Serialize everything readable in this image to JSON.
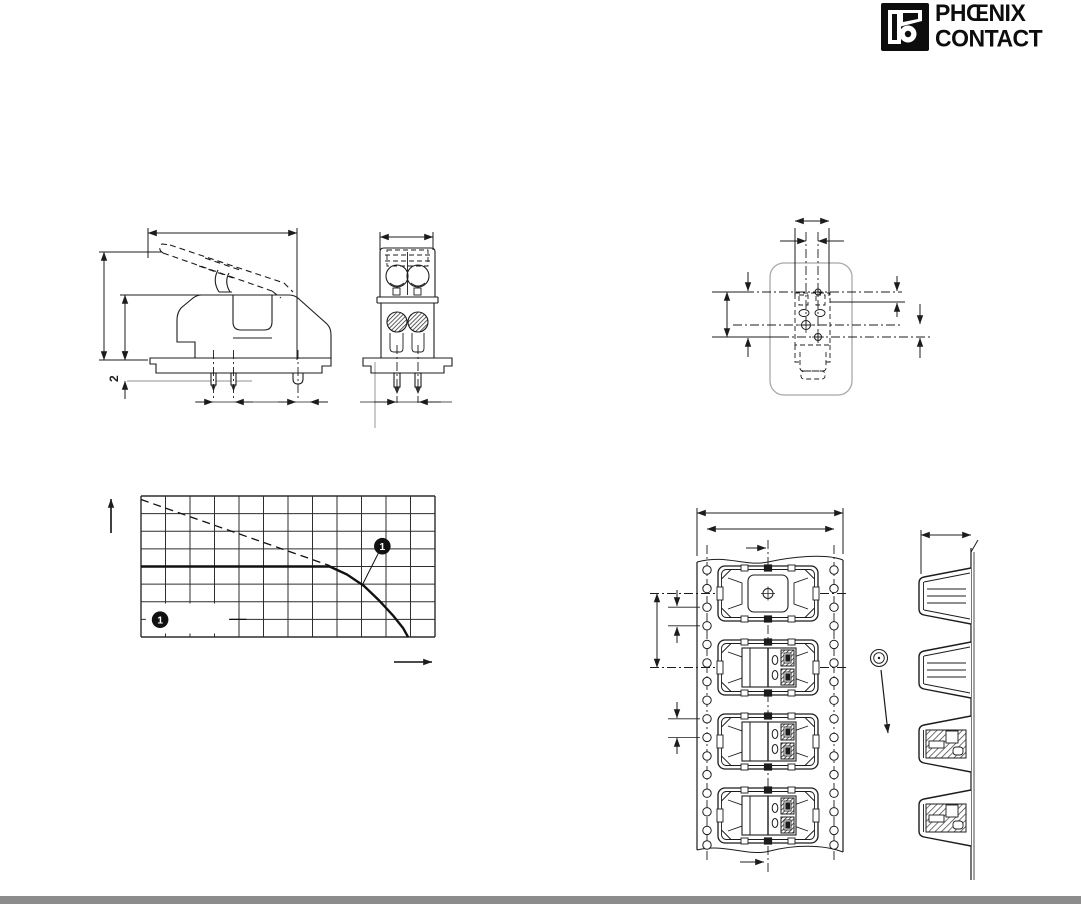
{
  "page": {
    "background": "#ffffff",
    "line_color": "#1c1c1c",
    "board_gray": "#a8a8a8",
    "footer_bar_color": "#8c8c8c"
  },
  "logo": {
    "line1": "PHŒNIX",
    "line2": "CONTACT"
  },
  "drawings": {
    "side_view": {
      "name": "connector-side-view",
      "dimension_label_2": "2"
    },
    "front_view": {
      "name": "connector-front-view"
    },
    "pcb_footprint": {
      "name": "pcb-drill-plan"
    },
    "tape_front": {
      "name": "carrier-tape-top-view",
      "pocket_count": 4
    },
    "tape_profile": {
      "name": "carrier-tape-side-profile",
      "pocket_count": 4
    }
  },
  "chart_data": {
    "type": "line",
    "title": "",
    "xlabel": "",
    "ylabel": "",
    "axis_tick_labels": "none-visible",
    "grid": {
      "cols": 12,
      "rows": 8,
      "visible": true
    },
    "xlim_grid_units": [
      0,
      12
    ],
    "ylim_grid_units": [
      0,
      8
    ],
    "series": [
      {
        "name": "nominal-limit",
        "style": "dashed",
        "width": 1.3,
        "points": [
          [
            0,
            7.8
          ],
          [
            7.7,
            4.05
          ]
        ]
      },
      {
        "name": "derating-curve",
        "style": "solid",
        "width": 2.4,
        "points": [
          [
            0,
            4
          ],
          [
            7.7,
            4
          ],
          [
            8.4,
            3.55
          ],
          [
            9.1,
            2.9
          ],
          [
            9.7,
            2.1
          ],
          [
            10.3,
            1.2
          ],
          [
            10.7,
            0.5
          ],
          [
            10.9,
            0
          ]
        ]
      }
    ],
    "callout": {
      "label": "1",
      "circle_at": [
        9.85,
        5.15
      ],
      "leader_to": [
        9.05,
        3.0
      ]
    },
    "legend": {
      "label": "1",
      "marker_at": [
        0.78,
        0.98
      ],
      "blank_box": [
        0.2,
        0.2,
        3.4,
        1.7
      ],
      "line_to": [
        4.3,
        1.0
      ]
    },
    "axes": {
      "y_arrow": "up",
      "x_arrow": "right",
      "legend_position": "bottom-left-inside"
    }
  }
}
